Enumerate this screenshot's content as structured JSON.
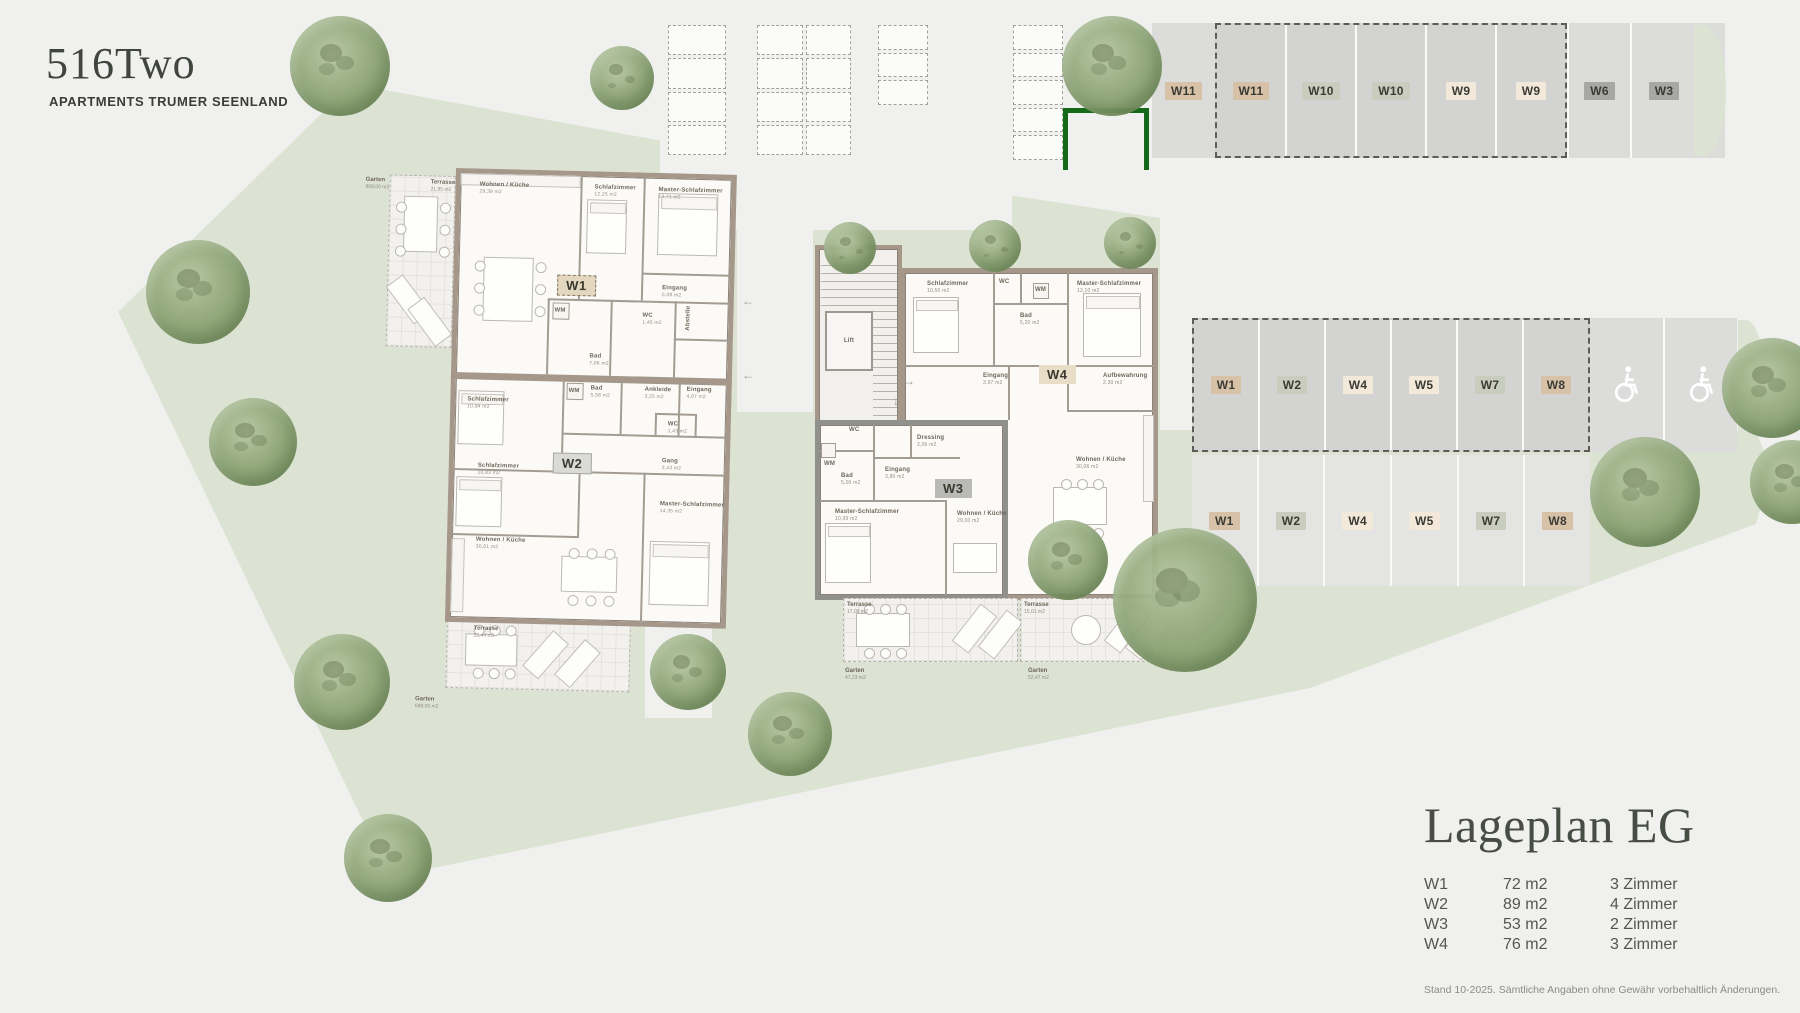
{
  "logo": {
    "title": "516Two",
    "subtitle": "APARTMENTS TRUMER SEENLAND"
  },
  "legend": {
    "title": "Lageplan EG",
    "units": [
      {
        "code": "W1",
        "area": "72 m2",
        "rooms": "3 Zimmer"
      },
      {
        "code": "W2",
        "area": "89 m2",
        "rooms": "4 Zimmer"
      },
      {
        "code": "W3",
        "area": "53 m2",
        "rooms": "2 Zimmer"
      },
      {
        "code": "W4",
        "area": "76 m2",
        "rooms": "3 Zimmer"
      }
    ],
    "footnote": "Stand 10-2025. Sämtliche Angaben ohne Gewähr vorbehaltlich Änderungen."
  },
  "parking_top": {
    "stalls": [
      {
        "label": "W11"
      },
      {
        "label": "W11"
      },
      {
        "label": "W10"
      },
      {
        "label": "W10"
      },
      {
        "label": "W9"
      },
      {
        "label": "W9"
      },
      {
        "label": "W6"
      },
      {
        "label": "W3"
      }
    ]
  },
  "parking_mid": {
    "row1": [
      {
        "label": "W1"
      },
      {
        "label": "W2"
      },
      {
        "label": "W4"
      },
      {
        "label": "W5"
      },
      {
        "label": "W7"
      },
      {
        "label": "W8"
      }
    ],
    "row2": [
      {
        "label": "W1"
      },
      {
        "label": "W2"
      },
      {
        "label": "W4"
      },
      {
        "label": "W5"
      },
      {
        "label": "W7"
      },
      {
        "label": "W8"
      }
    ]
  },
  "apartments": {
    "w1": {
      "badge": "W1",
      "rooms": [
        {
          "name": "Wohnen / Küche",
          "area": "29,39 m2"
        },
        {
          "name": "Schlafzimmer",
          "area": "12,25 m2"
        },
        {
          "name": "Master-Schlafzimmer",
          "area": "13,71 m2"
        },
        {
          "name": "Eingang",
          "area": "5,08 m2"
        },
        {
          "name": "WM",
          "area": ""
        },
        {
          "name": "WC",
          "area": "1,45 m2"
        },
        {
          "name": "Bad",
          "area": "7,06 m2"
        },
        {
          "name": "Abstelle",
          "area": "2,00 m2"
        }
      ]
    },
    "w2": {
      "badge": "W2",
      "rooms": [
        {
          "name": "Schlafzimmer",
          "area": "10,84 m2"
        },
        {
          "name": "WM",
          "area": ""
        },
        {
          "name": "Bad",
          "area": "5,58 m2"
        },
        {
          "name": "Ankleide",
          "area": "3,25 m2"
        },
        {
          "name": "Eingang",
          "area": "4,07 m2"
        },
        {
          "name": "WC",
          "area": "1,43 m2"
        },
        {
          "name": "Gang",
          "area": "3,43 m2"
        },
        {
          "name": "Schlafzimmer",
          "area": "10,83 m2"
        },
        {
          "name": "Master-Schlafzimmer",
          "area": "14,35 m2"
        },
        {
          "name": "Wohnen / Küche",
          "area": "30,61 m2"
        }
      ]
    },
    "w3": {
      "badge": "W3",
      "rooms": [
        {
          "name": "WC",
          "area": ""
        },
        {
          "name": "WM",
          "area": ""
        },
        {
          "name": "Bad",
          "area": "5,00 m2"
        },
        {
          "name": "Eingang",
          "area": "3,80 m2"
        },
        {
          "name": "Dressing",
          "area": "2,06 m2"
        },
        {
          "name": "Master-Schlafzimmer",
          "area": "10,99 m2"
        },
        {
          "name": "Wohnen / Küche",
          "area": "29,00 m2"
        }
      ]
    },
    "w4": {
      "badge": "W4",
      "rooms": [
        {
          "name": "Schlafzimmer",
          "area": "10,50 m2"
        },
        {
          "name": "WC",
          "area": ""
        },
        {
          "name": "WM",
          "area": ""
        },
        {
          "name": "Bad",
          "area": "5,20 m2"
        },
        {
          "name": "Master-Schlafzimmer",
          "area": "12,10 m2"
        },
        {
          "name": "Eingang",
          "area": "3,97 m2"
        },
        {
          "name": "Aufbewahrung",
          "area": "2,30 m2"
        },
        {
          "name": "Wohnen / Küche",
          "area": "30,06 m2"
        }
      ]
    },
    "stairwell": {
      "lift": "Lift"
    }
  },
  "outdoor": {
    "left_garten": {
      "name": "Garten",
      "area": "808,00 m2"
    },
    "left_terrasse": {
      "name": "Terrasse",
      "area": "21,85 m2"
    },
    "w2_terrasse": {
      "name": "Terrasse",
      "area": "22,44 m2"
    },
    "w2_garten": {
      "name": "Garten",
      "area": "698,00 m2"
    },
    "w3_terrasse": {
      "name": "Terrasse",
      "area": "17,09 m2"
    },
    "w3_garten": {
      "name": "Garten",
      "area": "47,23 m2"
    },
    "w4_terrasse": {
      "name": "Terrasse",
      "area": "15,01 m2"
    },
    "w4_garten": {
      "name": "Garten",
      "area": "52,47 m2"
    }
  },
  "icons": {
    "arrow_left": "←",
    "arrow_right": "→",
    "arrow_down": "↓"
  },
  "colors": {
    "site_green": "#dce3d3",
    "accent_green": "#15691a",
    "wall_beige": "#a5988a",
    "wall_gray": "#90908c",
    "badge_tan": "#d7c2a8",
    "badge_sage": "#c9cdbd",
    "badge_cream": "#f3e9da",
    "badge_gray": "#a7a7a3"
  }
}
